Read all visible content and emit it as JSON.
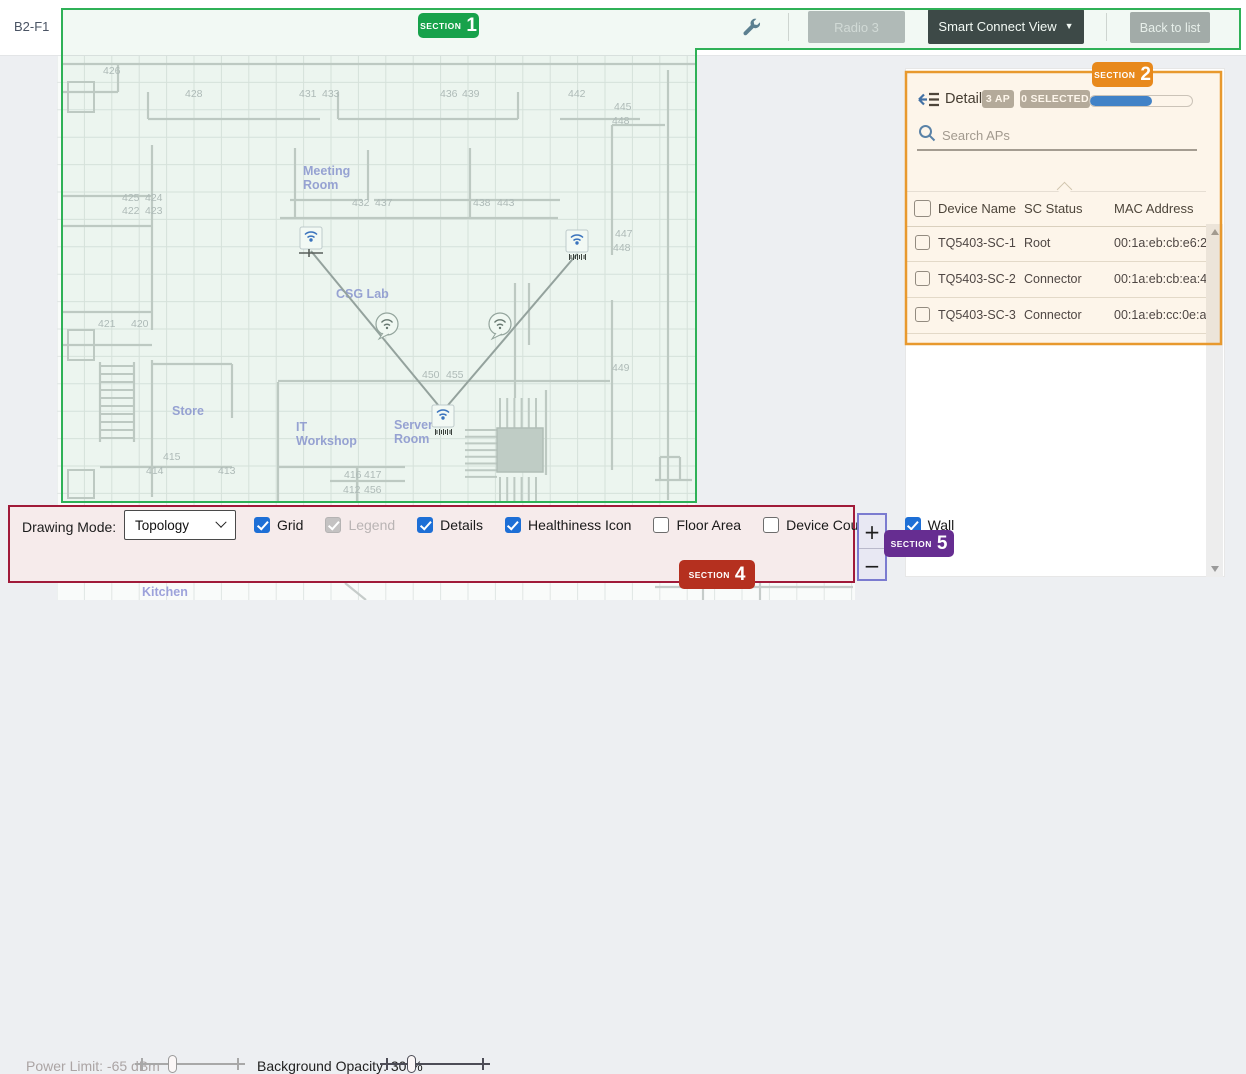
{
  "floor": {
    "label": "B2-F1"
  },
  "toolbar": {
    "radio_button": "Radio 3",
    "view_selector": "Smart Connect View",
    "back_button": "Back to list"
  },
  "sections": {
    "s1": {
      "label": "SECTION",
      "number": "1",
      "color": "#17a24b"
    },
    "s2": {
      "label": "SECTION",
      "number": "2",
      "color": "#e8891c"
    },
    "s4": {
      "label": "SECTION",
      "number": "4",
      "color": "#b5301f"
    },
    "s5": {
      "label": "SECTION",
      "number": "5",
      "color": "#662d91"
    }
  },
  "details_panel": {
    "title": "Details",
    "ap_badge": "3 AP",
    "selected_badge": "0 SELECTED",
    "progress_percent": 61,
    "search_placeholder": "Search APs",
    "table": {
      "headers": [
        "Device Name",
        "SC Status",
        "MAC Address"
      ],
      "rows": [
        {
          "device_name": "TQ5403-SC-1",
          "sc_status": "Root",
          "mac_address": "00:1a:eb:cb:e6:20"
        },
        {
          "device_name": "TQ5403-SC-2",
          "sc_status": "Connector",
          "mac_address": "00:1a:eb:cb:ea:40"
        },
        {
          "device_name": "TQ5403-SC-3",
          "sc_status": "Connector",
          "mac_address": "00:1a:eb:cc:0e:a0"
        }
      ]
    }
  },
  "drawing_bar": {
    "mode_label": "Drawing Mode:",
    "mode_value": "Topology",
    "checkboxes": [
      {
        "label": "Grid",
        "checked": true,
        "disabled": false
      },
      {
        "label": "Legend",
        "checked": true,
        "disabled": true
      },
      {
        "label": "Details",
        "checked": true,
        "disabled": false
      },
      {
        "label": "Healthiness Icon",
        "checked": true,
        "disabled": false
      },
      {
        "label": "Floor Area",
        "checked": false,
        "disabled": false
      },
      {
        "label": "Device Counter",
        "checked": false,
        "disabled": false
      },
      {
        "label": "Wall",
        "checked": true,
        "disabled": false
      }
    ],
    "power_limit_label": "Power Limit: -65 dBm",
    "power_limit_percent": 34,
    "opacity_label": "Background Opacity: 30 %",
    "opacity_percent": 28
  },
  "zoom_control": {
    "zoom_in": "+",
    "zoom_out": "−"
  },
  "map": {
    "room_labels": [
      {
        "lines": [
          "Meeting",
          "Room"
        ],
        "x": 303,
        "y": 175
      },
      {
        "lines": [
          "CSG Lab"
        ],
        "x": 336,
        "y": 298
      },
      {
        "lines": [
          "Store"
        ],
        "x": 172,
        "y": 415
      },
      {
        "lines": [
          "IT",
          "Workshop"
        ],
        "x": 296,
        "y": 431
      },
      {
        "lines": [
          "Server",
          "Room"
        ],
        "x": 394,
        "y": 429
      },
      {
        "lines": [
          "Kitchen"
        ],
        "x": 142,
        "y": 596
      }
    ],
    "room_numbers": [
      {
        "t": "426",
        "x": 103,
        "y": 74
      },
      {
        "t": "428",
        "x": 185,
        "y": 97
      },
      {
        "t": "431",
        "x": 299,
        "y": 97
      },
      {
        "t": "433",
        "x": 322,
        "y": 97
      },
      {
        "t": "436",
        "x": 440,
        "y": 97
      },
      {
        "t": "439",
        "x": 462,
        "y": 97
      },
      {
        "t": "442",
        "x": 568,
        "y": 97
      },
      {
        "t": "445",
        "x": 614,
        "y": 110
      },
      {
        "t": "448",
        "x": 612,
        "y": 124
      },
      {
        "t": "425",
        "x": 122,
        "y": 201
      },
      {
        "t": "424",
        "x": 145,
        "y": 201
      },
      {
        "t": "422",
        "x": 122,
        "y": 214
      },
      {
        "t": "423",
        "x": 145,
        "y": 214
      },
      {
        "t": "432",
        "x": 352,
        "y": 206
      },
      {
        "t": "437",
        "x": 375,
        "y": 206
      },
      {
        "t": "438",
        "x": 473,
        "y": 206
      },
      {
        "t": "443",
        "x": 497,
        "y": 206
      },
      {
        "t": "421",
        "x": 98,
        "y": 327
      },
      {
        "t": "420",
        "x": 131,
        "y": 327
      },
      {
        "t": "447",
        "x": 615,
        "y": 237
      },
      {
        "t": "448",
        "x": 613,
        "y": 251
      },
      {
        "t": "449",
        "x": 612,
        "y": 371
      },
      {
        "t": "450",
        "x": 422,
        "y": 378
      },
      {
        "t": "455",
        "x": 446,
        "y": 378
      },
      {
        "t": "415",
        "x": 163,
        "y": 460
      },
      {
        "t": "414",
        "x": 146,
        "y": 474
      },
      {
        "t": "413",
        "x": 218,
        "y": 474
      },
      {
        "t": "416",
        "x": 344,
        "y": 478
      },
      {
        "t": "417",
        "x": 364,
        "y": 478
      },
      {
        "t": "412",
        "x": 343,
        "y": 493
      },
      {
        "t": "456",
        "x": 364,
        "y": 493
      }
    ],
    "aps": [
      {
        "x": 311,
        "y": 239,
        "root": true
      },
      {
        "x": 577,
        "y": 242,
        "root": false
      },
      {
        "x": 443,
        "y": 417,
        "root": false
      }
    ],
    "links": [
      [
        0,
        2
      ],
      [
        1,
        2
      ]
    ],
    "health_icons": [
      {
        "x": 387,
        "y": 324
      },
      {
        "x": 500,
        "y": 324
      }
    ],
    "colors": {
      "grid": "#e0e6e4",
      "wall": "#c6ccca",
      "label": "#8d93d6",
      "number": "#b6bcbe",
      "link": "#9aa2a2",
      "ap_accent": "#3a6fc4"
    }
  },
  "colors": {
    "accent_blue": "#1d6fd6",
    "progress_blue": "#2e7fd8",
    "section_green": "#17a24b",
    "section_orange": "#e8891c",
    "section_red": "#b5301f",
    "section_purple": "#662d91"
  }
}
